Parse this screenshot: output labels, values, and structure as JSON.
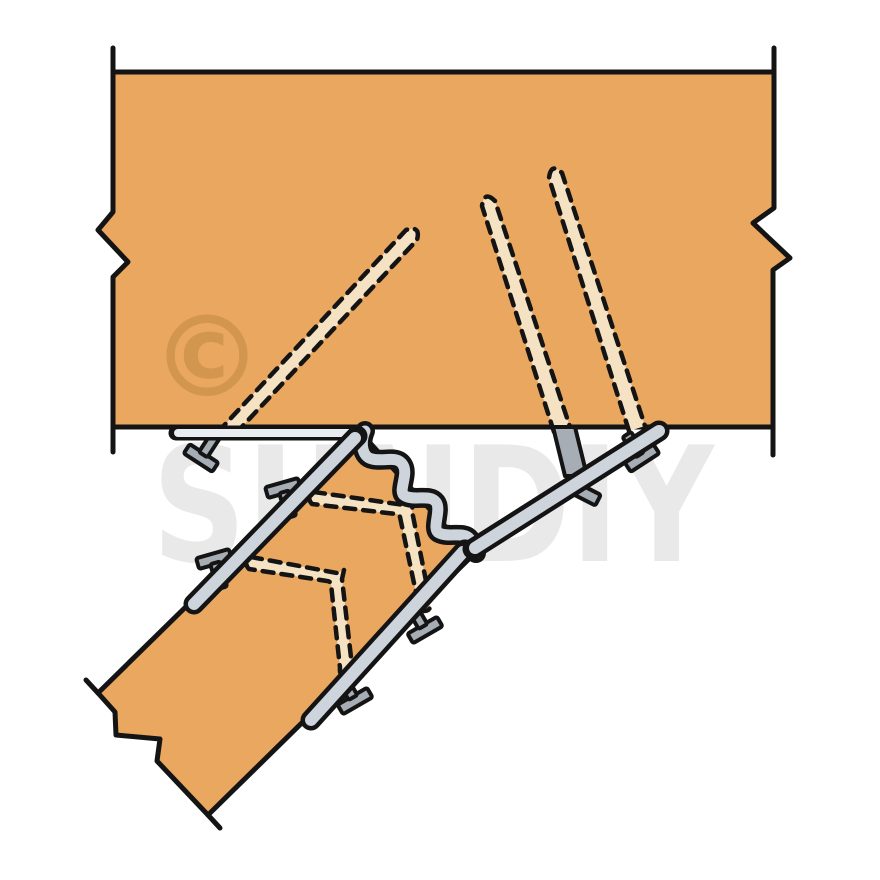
{
  "watermark": {
    "text": "SUNDIY",
    "copyright_symbol": "©"
  },
  "colors": {
    "background": "#ffffff",
    "wood": "#e9a75f",
    "outline": "#141414",
    "hidden_nail_fill": "#f5e2c3",
    "metal": "#ced4db",
    "metal_light": "#e9edf1",
    "nail_gray": "#a7adb5",
    "watermark_gray": "#e9e9e9",
    "copyright_orange": "#d3964e"
  },
  "parts": [
    "header-beam",
    "sloped-joist",
    "adjustable-joist-hanger",
    "hanger-top-flange",
    "hanger-crimped-bend",
    "hanger-diagonal-strap",
    "hanger-side-straps",
    "hidden-nails-dashed",
    "protruding-nail-heads"
  ]
}
